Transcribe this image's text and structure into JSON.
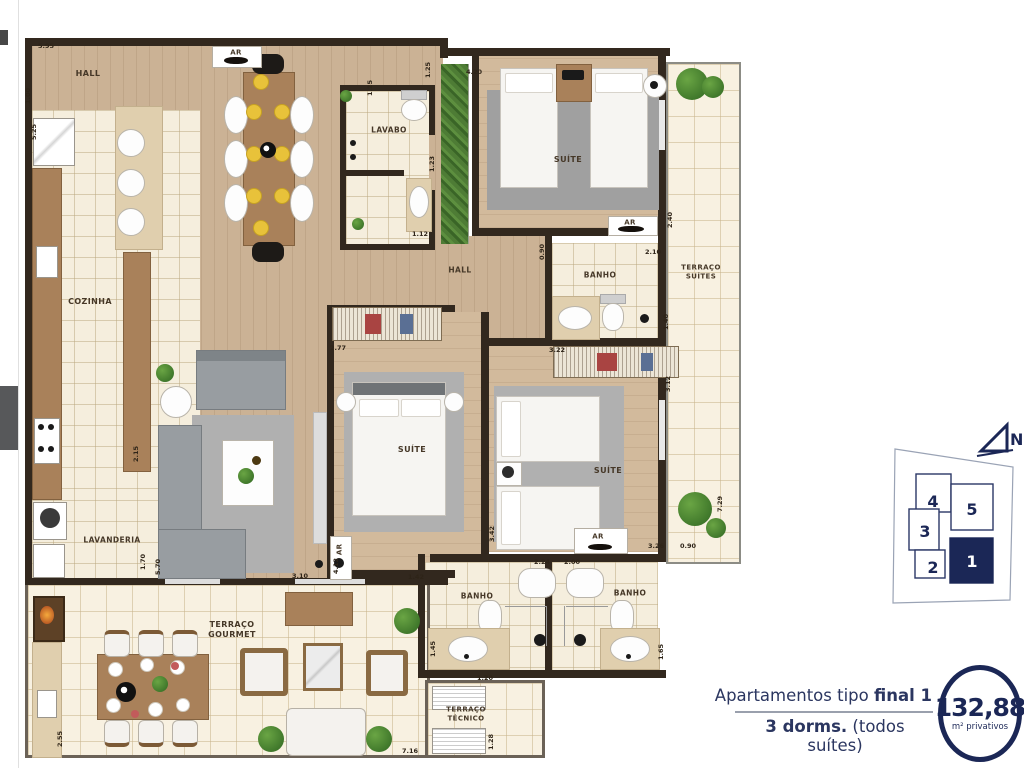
{
  "labels": {
    "hall": "HALL",
    "ar": "AR",
    "cozinha": "COZINHA",
    "lavabo": "LAVABO",
    "suite": "SUÍTE",
    "banho": "BANHO",
    "lavanderia": "LAVANDERIA",
    "terraco_suites": "TERRAÇO\nSUÍTES",
    "terraco_gourmet": "TERRAÇO\nGOURMET",
    "terraco_tecnico": "TERRAÇO\nTÉCNICO"
  },
  "dims": [
    "5.95",
    "1.00",
    "5.25",
    "1.25",
    "1.25",
    "4.20",
    "1.23",
    "1.12",
    "2.40",
    "2.10",
    "0.90",
    "1.40",
    "2.77",
    "3.22",
    "3.12",
    "2.15",
    "1.70",
    "5.70",
    "3.10",
    "4.12",
    "1.42",
    "3.42",
    "2.24",
    "2.00",
    "3.26",
    "0.90",
    "7.29",
    "1.45",
    "1.65",
    "1.20",
    "1.28",
    "7.16",
    "2.55"
  ],
  "keyplan": {
    "north": "N",
    "unit1": "1",
    "unit2": "2",
    "unit3": "3",
    "unit4": "4",
    "unit5": "5"
  },
  "info": {
    "line1_normal": "Apartamentos tipo ",
    "line1_bold": "final 1",
    "line2_bold": "3 dorms.",
    "line2_normal": " (todos suítes)",
    "area_value": "132,88",
    "area_unit": "m² privativos"
  },
  "colors": {
    "navy": "#1b2756",
    "wall": "#32281e",
    "wood_floor": "#cbb295",
    "tile_floor": "#f5eedd",
    "plate_yellow": "#e8c23a",
    "plant_green": "#3f7a2c"
  }
}
